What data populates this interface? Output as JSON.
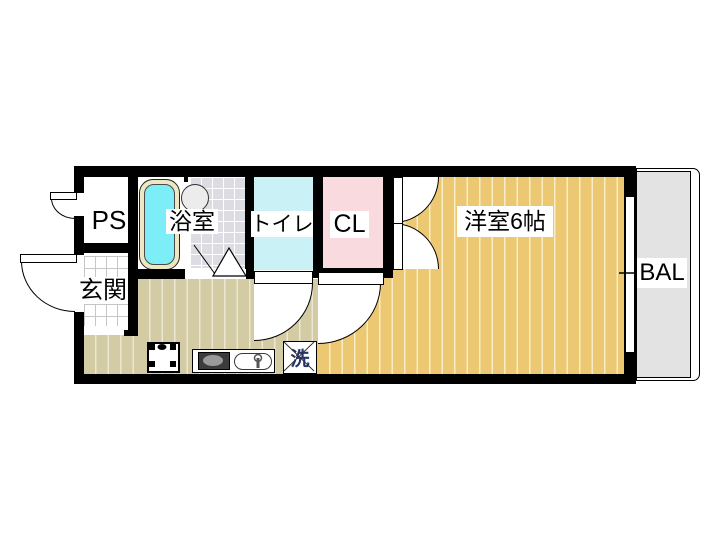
{
  "title": "apartment-floor-plan-1K",
  "rooms": {
    "ps": {
      "label": "PS"
    },
    "bathroom": {
      "label": "浴室"
    },
    "toilet": {
      "label": "トイレ"
    },
    "closet": {
      "label": "CL"
    },
    "western_room": {
      "label": "洋室6帖"
    },
    "entrance": {
      "label": "玄関"
    },
    "balcony": {
      "label": "BAL"
    }
  },
  "fixtures": {
    "washing_machine": {
      "label": "洗"
    }
  },
  "colors": {
    "wall": "#000000",
    "western_room_floor": "#ecc873",
    "kitchen_floor": "#d2cba3",
    "toilet_fill": "#c9f1f6",
    "closet_fill": "#f9dade",
    "bathtub_water": "#7deef8",
    "bathtub_rim": "#ede8c2",
    "bath_tile": "#dcdce2",
    "balcony": "#e3e3e3"
  }
}
